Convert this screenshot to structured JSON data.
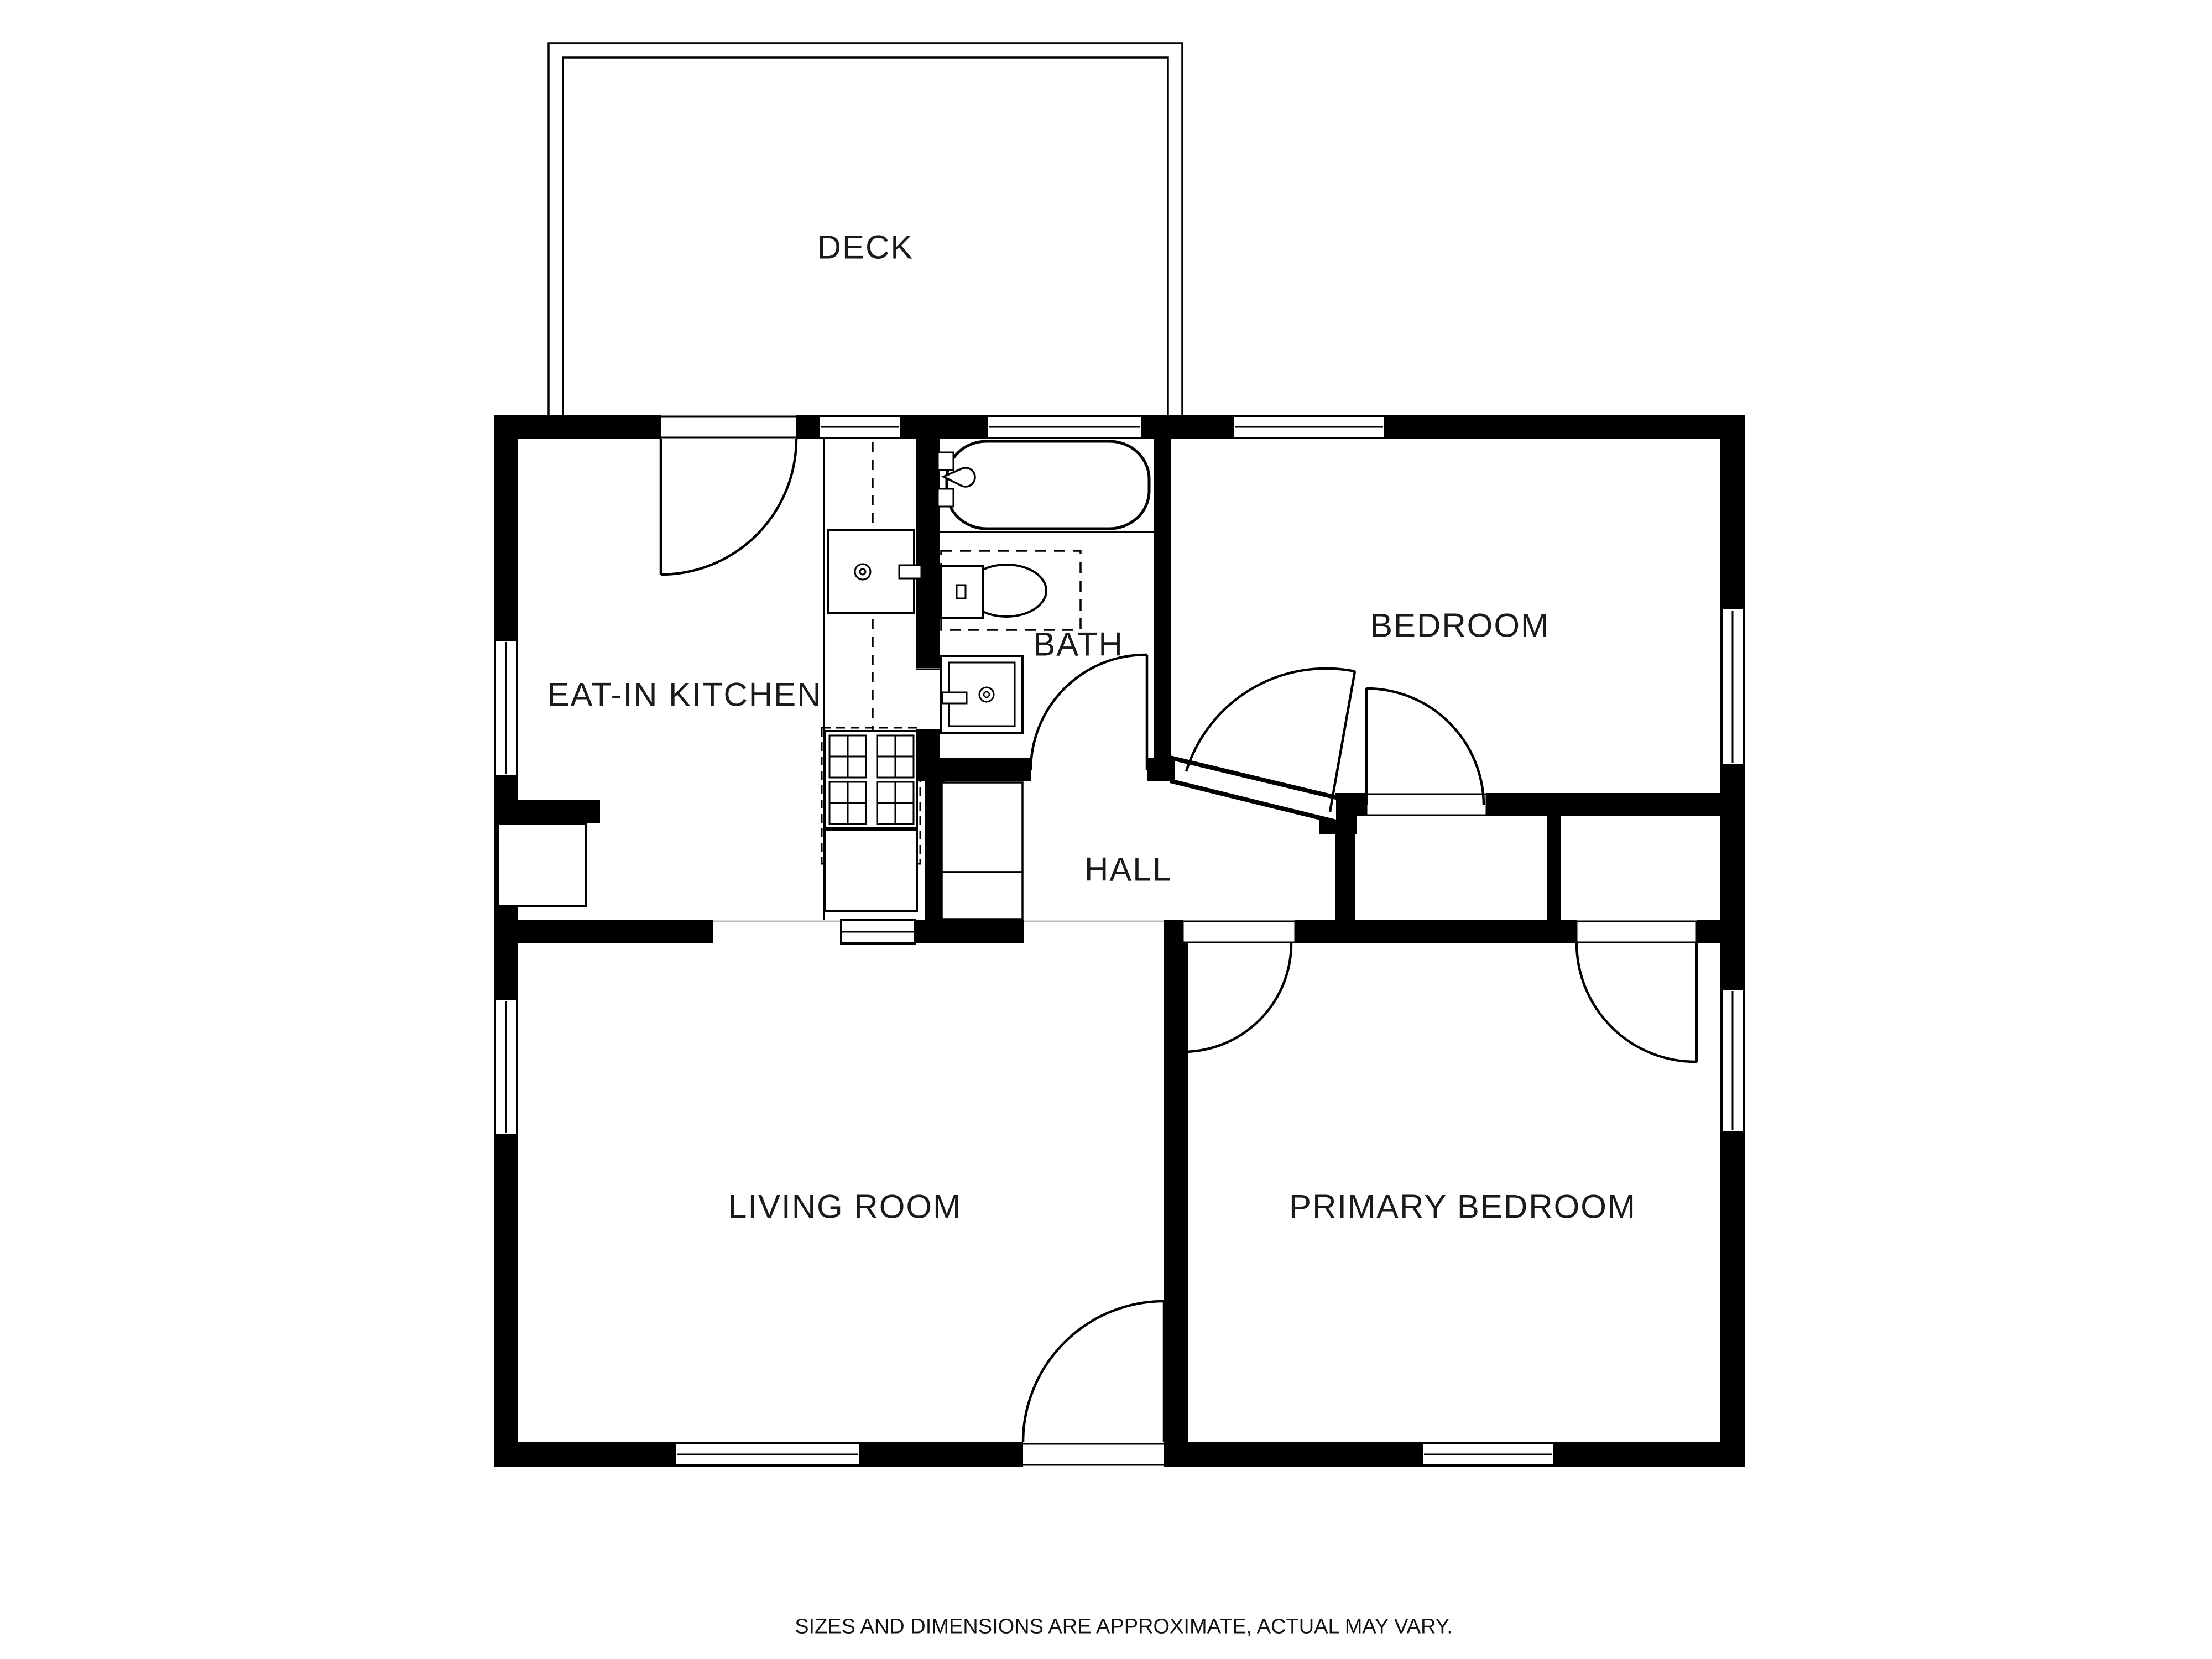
{
  "plan": {
    "rooms": {
      "deck": {
        "label": "DECK"
      },
      "kitchen": {
        "label": "EAT-IN KITCHEN"
      },
      "bath": {
        "label": "BATH"
      },
      "bedroom": {
        "label": "BEDROOM"
      },
      "hall": {
        "label": "HALL"
      },
      "living_room": {
        "label": "LIVING ROOM"
      },
      "primary_bedroom": {
        "label": "PRIMARY BEDROOM"
      }
    },
    "disclaimer": "SIZES AND DIMENSIONS ARE APPROXIMATE, ACTUAL MAY VARY.",
    "colors": {
      "walls": "#000000",
      "background": "#ffffff",
      "lines": "#1a1a1a",
      "seam": "#bbbbbb"
    }
  }
}
